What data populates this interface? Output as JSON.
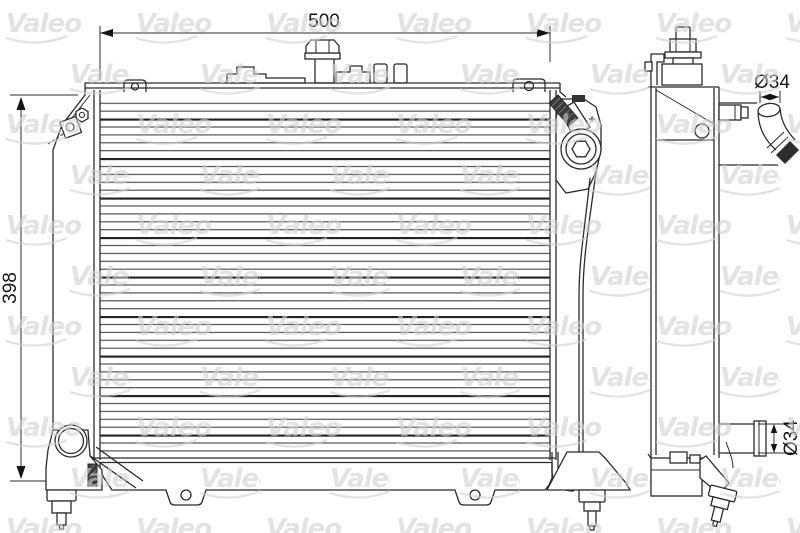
{
  "watermark": {
    "text": "Valeo"
  },
  "front_view": {
    "width_dimension": "500",
    "height_dimension": "398"
  },
  "side_view": {
    "top_hose_diameter": "Ø34",
    "bottom_pipe_diameter": "Ø34"
  }
}
